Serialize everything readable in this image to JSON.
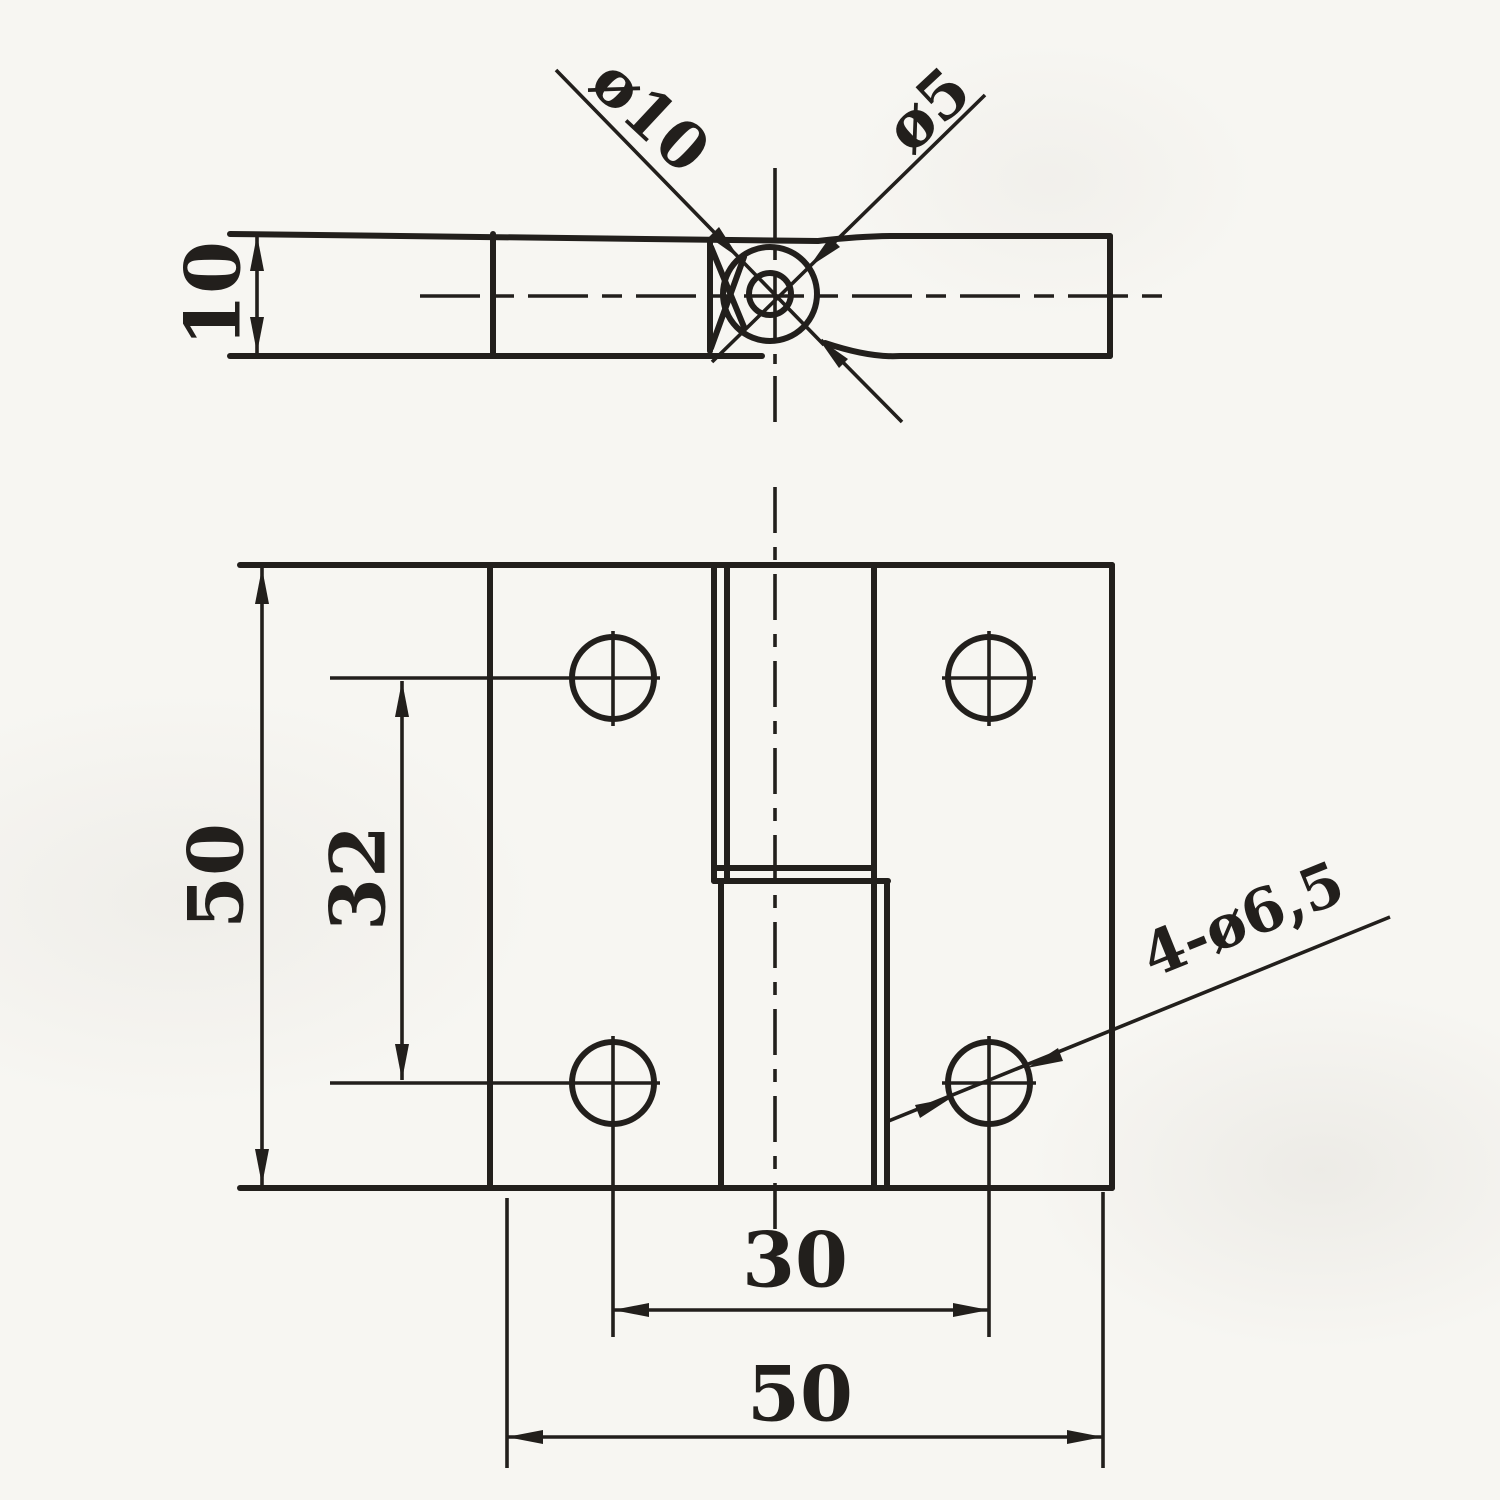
{
  "drawing": {
    "labels": {
      "thickness": "10",
      "barrel_diameter": "ø10",
      "pin_diameter": "ø5",
      "height": "50",
      "hole_spacing_vertical": "32",
      "hole_spacing_horizontal": "30",
      "width": "50",
      "holes": "4-ø6,5"
    },
    "colors": {
      "ink": "#221f1c",
      "paper": "#f7f6f2"
    }
  }
}
